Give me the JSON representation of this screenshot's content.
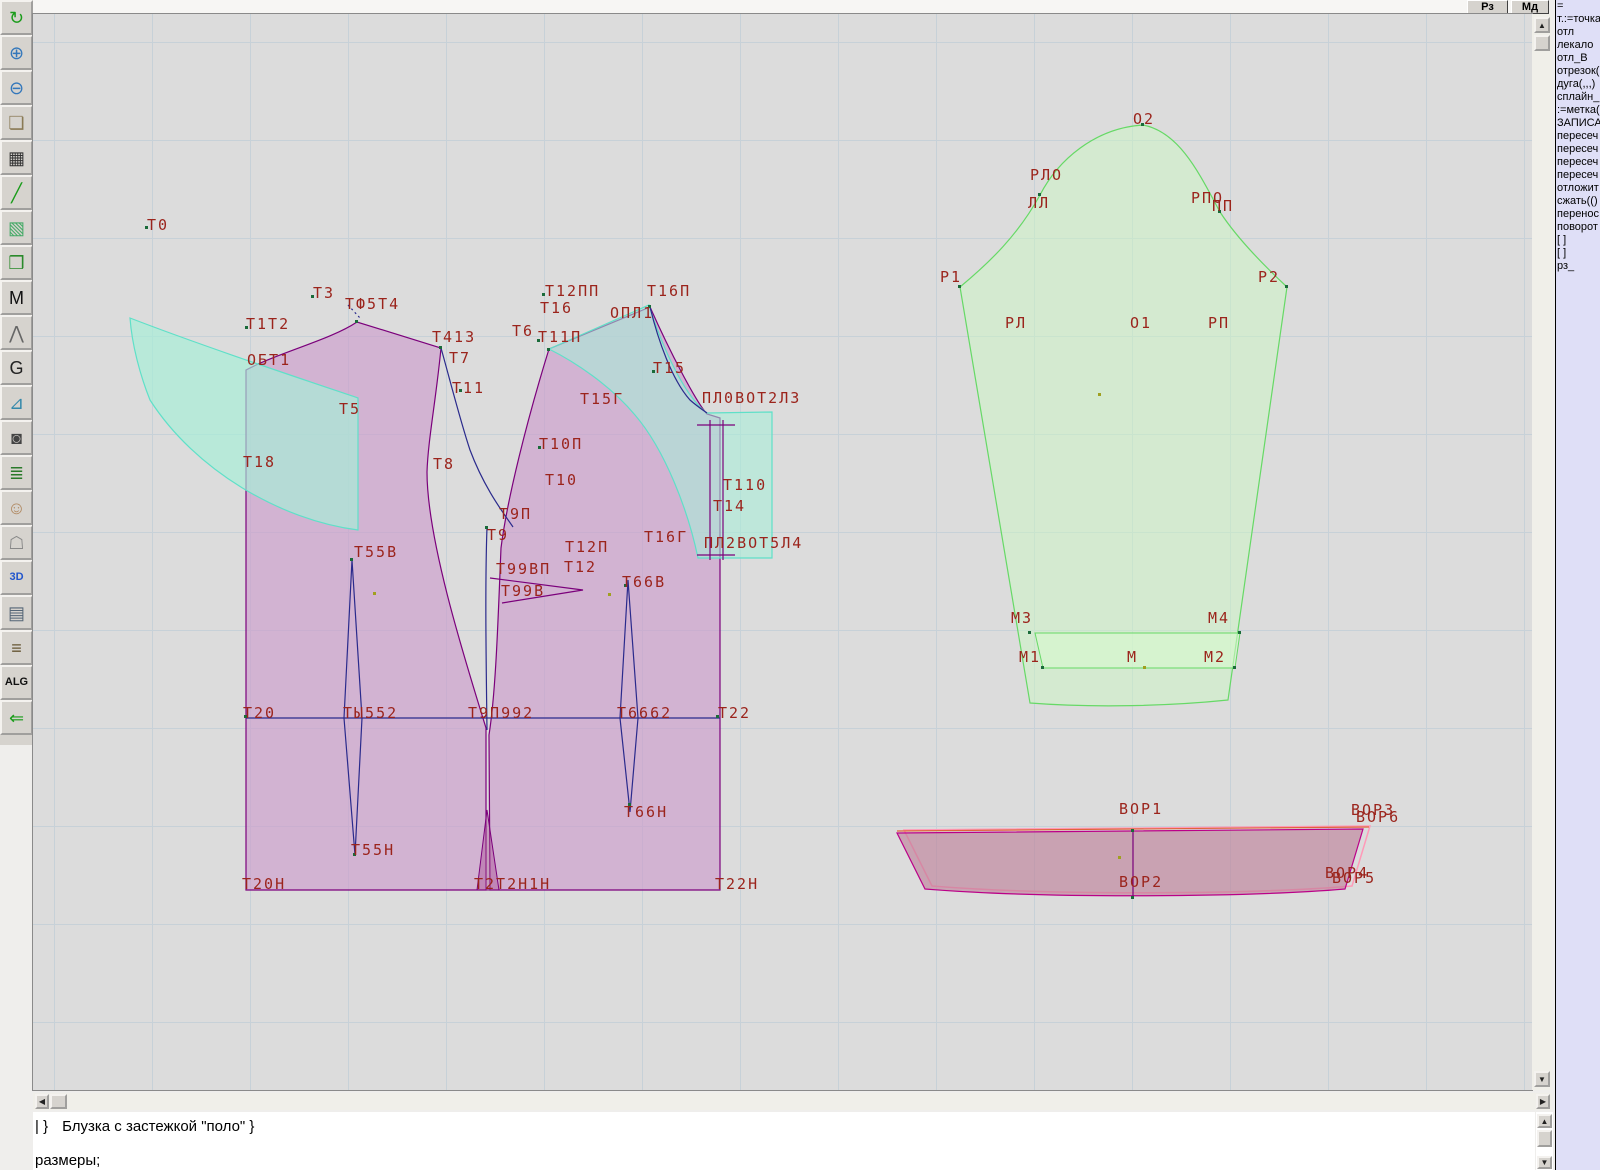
{
  "top_buttons": [
    {
      "label": "Рз"
    },
    {
      "label": "Мд"
    }
  ],
  "toolbar": {
    "buttons": [
      {
        "name": "refresh-button",
        "icon": "refresh-icon",
        "glyph": "↻",
        "color": "#1a9c1a"
      },
      {
        "name": "zoom-in-button",
        "icon": "zoom-in-icon",
        "glyph": "⊕",
        "color": "#3377bb"
      },
      {
        "name": "zoom-out-button",
        "icon": "zoom-out-icon",
        "glyph": "⊖",
        "color": "#3377bb"
      },
      {
        "name": "preview-piece-button",
        "icon": "piece-lens-icon",
        "glyph": "❏",
        "color": "#8a7a55"
      },
      {
        "name": "grid-button",
        "icon": "grid-icon",
        "glyph": "▦",
        "color": "#333333"
      },
      {
        "name": "measure-line-button",
        "icon": "line-icon",
        "glyph": "╱",
        "color": "#1a9c1a"
      },
      {
        "name": "image-button",
        "icon": "image-icon",
        "glyph": "▧",
        "color": "#44aa66"
      },
      {
        "name": "pattern-piece-button",
        "icon": "pattern-icon",
        "glyph": "❒",
        "color": "#2a8a2a"
      },
      {
        "name": "pattern-m-button",
        "icon": "letter-m-icon",
        "glyph": "M",
        "color": "#111111"
      },
      {
        "name": "compass-button",
        "icon": "compass-icon",
        "glyph": "⋀",
        "color": "#666666"
      },
      {
        "name": "grace-button",
        "icon": "letter-g-icon",
        "glyph": "G",
        "color": "#222222"
      },
      {
        "name": "ruler-button",
        "icon": "ruler-icon",
        "glyph": "⊿",
        "color": "#3388aa"
      },
      {
        "name": "camera-button",
        "icon": "camera-icon",
        "glyph": "◙",
        "color": "#444444"
      },
      {
        "name": "table-button",
        "icon": "spreadsheet-icon",
        "glyph": "≣",
        "color": "#2a7a2a"
      },
      {
        "name": "photo-button",
        "icon": "portrait-icon",
        "glyph": "☺",
        "color": "#b08860"
      },
      {
        "name": "garment-button",
        "icon": "jacket-icon",
        "glyph": "☖",
        "color": "#888888"
      },
      {
        "name": "3d-button",
        "icon": "3d-icon",
        "glyph": "3D",
        "color": "#2255cc"
      },
      {
        "name": "list-button",
        "icon": "text-list-icon",
        "glyph": "▤",
        "color": "#556677"
      },
      {
        "name": "books-button",
        "icon": "books-icon",
        "glyph": "≡",
        "color": "#665533"
      },
      {
        "name": "alg-button",
        "icon": "alg-icon",
        "glyph": "ALG",
        "color": "#111111"
      },
      {
        "name": "exit-button",
        "icon": "exit-arrow-icon",
        "glyph": "⇐",
        "color": "#1a9c1a"
      }
    ]
  },
  "right_panel": {
    "items": [
      "=",
      "т.:=точка",
      "отл",
      "лекало",
      "отл_В",
      "отрезок(",
      "дуга(,,,)",
      "сплайн_",
      ":=метка(",
      "ЗАПИСА",
      "пересеч",
      "пересеч",
      "пересеч",
      "пересеч",
      "отложит",
      "сжать(()",
      "перенос",
      "поворот",
      "[ ]",
      "[ ]",
      "рз_"
    ]
  },
  "status": {
    "line1_prefix": "| }",
    "line1": "Блузка с застежкой \"поло\" }",
    "line2": "размеры;"
  },
  "canvas": {
    "colors": {
      "background": "#dcdcdc",
      "grid": "#c7d1d8",
      "label": "#9b241c",
      "bodice_fill": "#d2b4d2",
      "bodice_stroke": "#7b007b",
      "facing_fill": "#b6ead9",
      "facing_stroke": "#5fe0c8",
      "sleeve_fill": "#d4ead0",
      "sleeve_stroke": "#66d966",
      "collar_fill": "#c9a2b2",
      "collar_stroke": "#bb0088",
      "construction": "#2a2a8c"
    },
    "labels": [
      {
        "t": "Т0",
        "x": 114,
        "y": 204
      },
      {
        "t": "Т3",
        "x": 280,
        "y": 272
      },
      {
        "t": "ТФ5Т4",
        "x": 312,
        "y": 283
      },
      {
        "t": "Т1Т2",
        "x": 213,
        "y": 303
      },
      {
        "t": "ОБТ1",
        "x": 214,
        "y": 339
      },
      {
        "t": "Т413",
        "x": 399,
        "y": 316
      },
      {
        "t": "Т7",
        "x": 416,
        "y": 337
      },
      {
        "t": "Т11",
        "x": 419,
        "y": 367
      },
      {
        "t": "Т5",
        "x": 306,
        "y": 388
      },
      {
        "t": "Т18",
        "x": 210,
        "y": 441
      },
      {
        "t": "Т8",
        "x": 400,
        "y": 443
      },
      {
        "t": "Т12ПП",
        "x": 512,
        "y": 270
      },
      {
        "t": "Т16",
        "x": 507,
        "y": 287
      },
      {
        "t": "Т16П",
        "x": 614,
        "y": 270
      },
      {
        "t": "ОПЛ1",
        "x": 577,
        "y": 292
      },
      {
        "t": "Т6",
        "x": 479,
        "y": 310
      },
      {
        "t": "Т11П",
        "x": 505,
        "y": 316
      },
      {
        "t": "Т15",
        "x": 620,
        "y": 347
      },
      {
        "t": "Т15Г",
        "x": 547,
        "y": 378
      },
      {
        "t": "ПЛ0ВОТ2Л3",
        "x": 669,
        "y": 377
      },
      {
        "t": "Т10П",
        "x": 506,
        "y": 423
      },
      {
        "t": "Т10",
        "x": 512,
        "y": 459
      },
      {
        "t": "Т110",
        "x": 690,
        "y": 464
      },
      {
        "t": "Т14",
        "x": 680,
        "y": 485
      },
      {
        "t": "Т9П",
        "x": 466,
        "y": 493
      },
      {
        "t": "Т9",
        "x": 454,
        "y": 514
      },
      {
        "t": "Т16Г",
        "x": 611,
        "y": 516
      },
      {
        "t": "ПЛ2ВОТ5Л4",
        "x": 671,
        "y": 522
      },
      {
        "t": "Т55В",
        "x": 321,
        "y": 531
      },
      {
        "t": "Т12П",
        "x": 532,
        "y": 526
      },
      {
        "t": "Т12",
        "x": 531,
        "y": 546
      },
      {
        "t": "Т99ВП",
        "x": 463,
        "y": 548
      },
      {
        "t": "Т99В",
        "x": 468,
        "y": 570
      },
      {
        "t": "Т66В",
        "x": 589,
        "y": 561
      },
      {
        "t": "Т20",
        "x": 210,
        "y": 692
      },
      {
        "t": "ТЫ552",
        "x": 310,
        "y": 692
      },
      {
        "t": "Т9П992",
        "x": 435,
        "y": 692
      },
      {
        "t": "Т6662",
        "x": 584,
        "y": 692
      },
      {
        "t": "Т22",
        "x": 685,
        "y": 692
      },
      {
        "t": "Т66Н",
        "x": 591,
        "y": 791
      },
      {
        "t": "Т55Н",
        "x": 318,
        "y": 829
      },
      {
        "t": "Т20Н",
        "x": 209,
        "y": 863
      },
      {
        "t": "Т2Т2Н1Н",
        "x": 441,
        "y": 863
      },
      {
        "t": "Т22Н",
        "x": 682,
        "y": 863
      },
      {
        "t": "О2",
        "x": 1100,
        "y": 98
      },
      {
        "t": "РЛО",
        "x": 997,
        "y": 154
      },
      {
        "t": "ЛЛ",
        "x": 995,
        "y": 182
      },
      {
        "t": "РПО",
        "x": 1158,
        "y": 177
      },
      {
        "t": "ПП",
        "x": 1179,
        "y": 185
      },
      {
        "t": "Р1",
        "x": 907,
        "y": 256
      },
      {
        "t": "Р2",
        "x": 1225,
        "y": 256
      },
      {
        "t": "РЛ",
        "x": 972,
        "y": 302
      },
      {
        "t": "О1",
        "x": 1097,
        "y": 302
      },
      {
        "t": "РП",
        "x": 1175,
        "y": 302
      },
      {
        "t": "М3",
        "x": 978,
        "y": 597
      },
      {
        "t": "М4",
        "x": 1175,
        "y": 597
      },
      {
        "t": "М1",
        "x": 986,
        "y": 636
      },
      {
        "t": "М",
        "x": 1094,
        "y": 636
      },
      {
        "t": "М2",
        "x": 1171,
        "y": 636
      },
      {
        "t": "ВОР1",
        "x": 1086,
        "y": 788
      },
      {
        "t": "ВОР3",
        "x": 1318,
        "y": 789
      },
      {
        "t": "ВОР6",
        "x": 1323,
        "y": 796
      },
      {
        "t": "ВОР2",
        "x": 1086,
        "y": 861
      },
      {
        "t": "ВОР4",
        "x": 1292,
        "y": 852
      },
      {
        "t": "ВОР5",
        "x": 1299,
        "y": 857
      }
    ]
  }
}
